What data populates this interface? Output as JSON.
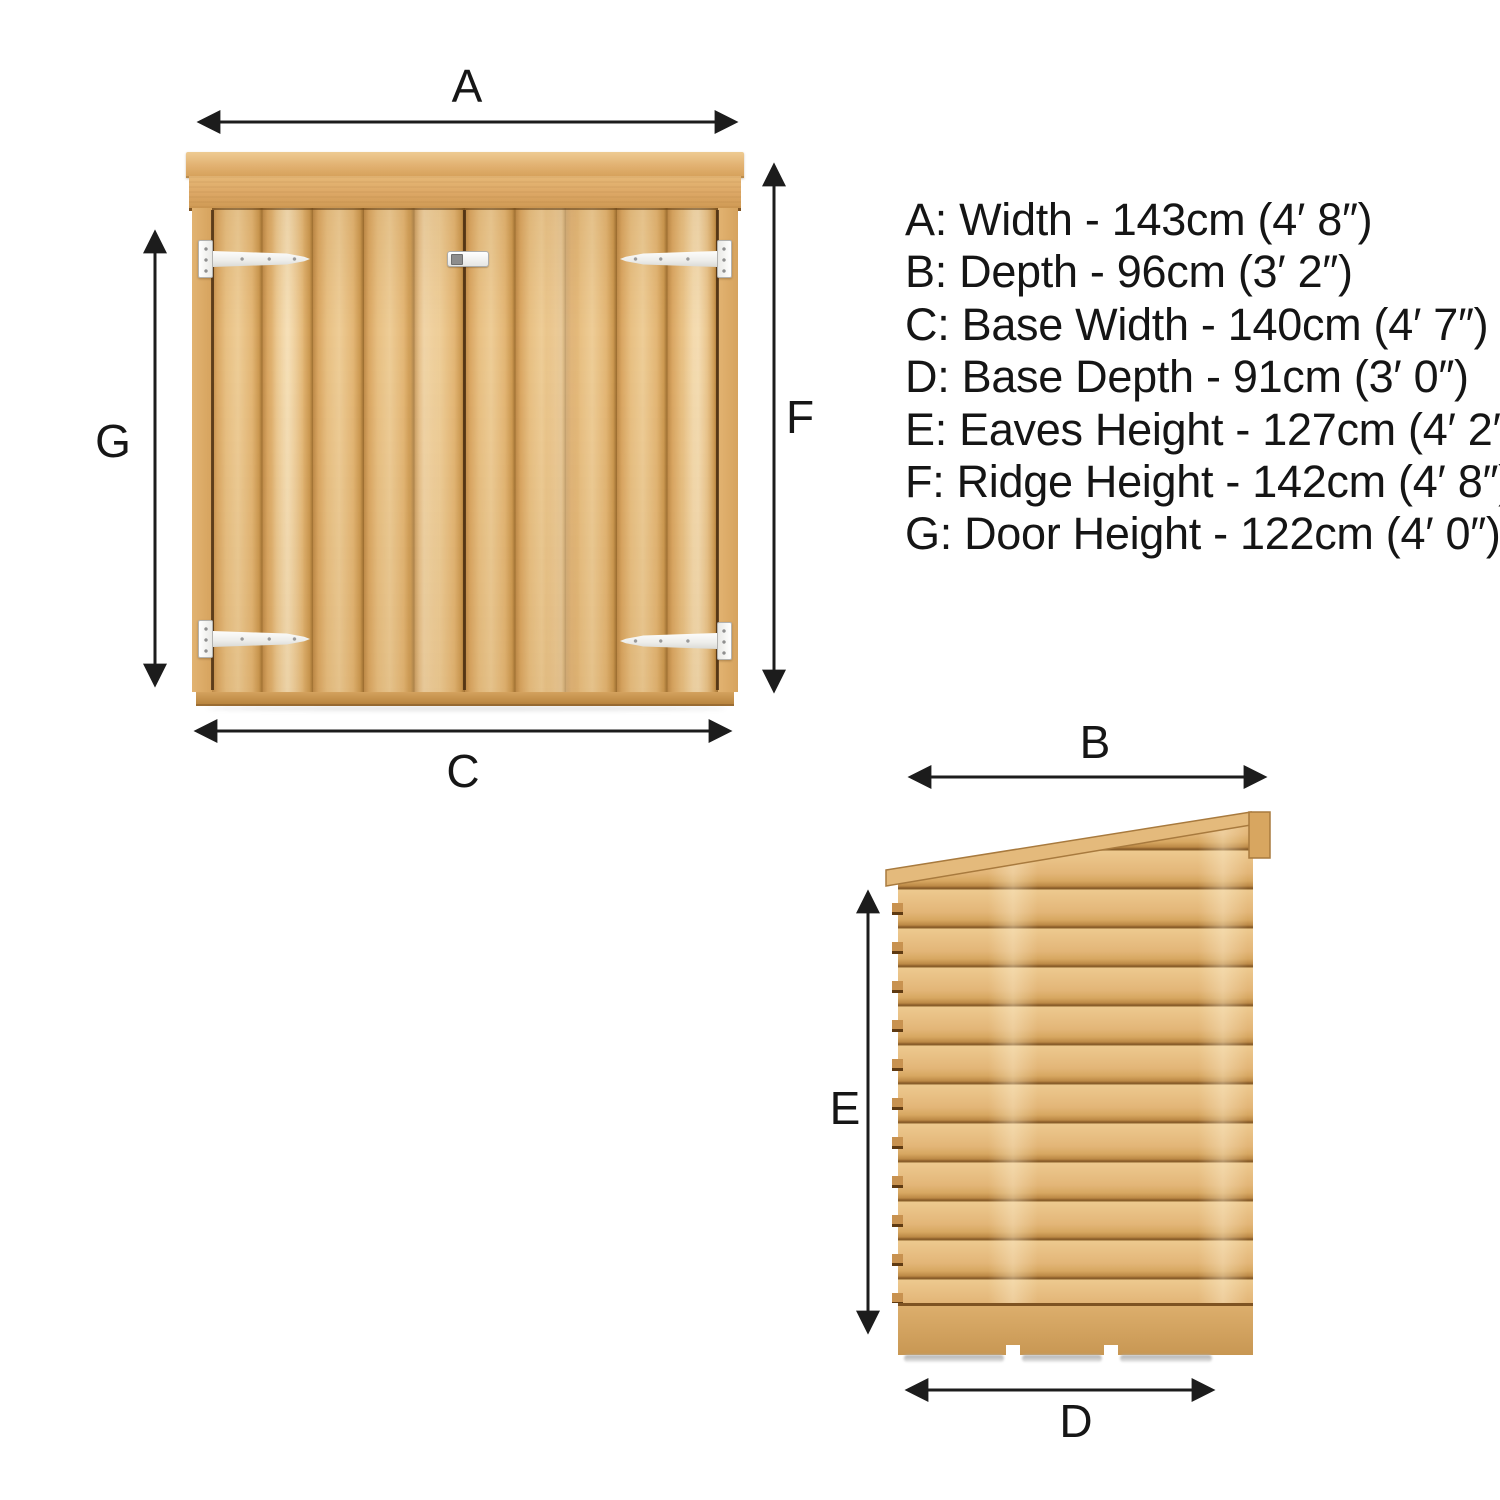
{
  "title": "Shed dimensions diagram",
  "colors": {
    "background": "#ffffff",
    "arrow": "#1c1c1c",
    "text": "#151515",
    "wood_light": "#eecd97",
    "wood_mid": "#ddae6c",
    "wood_dark": "#b07c3c",
    "wood_seam": "#7e5322",
    "hinge_white": "#f6f6f4",
    "hinge_border": "#b2b2b0",
    "shadow_gray": "#ababab"
  },
  "dimensions": [
    {
      "letter": "A",
      "name": "Width",
      "cm": "143cm",
      "imperial": "4′ 8″",
      "text": "A: Width - 143cm (4′ 8″)"
    },
    {
      "letter": "B",
      "name": "Depth",
      "cm": "96cm",
      "imperial": "3′ 2″",
      "text": "B: Depth - 96cm (3′ 2″)"
    },
    {
      "letter": "C",
      "name": "Base Width",
      "cm": "140cm",
      "imperial": "4′ 7″",
      "text": "C: Base Width - 140cm (4′ 7″)"
    },
    {
      "letter": "D",
      "name": "Base Depth",
      "cm": "91cm",
      "imperial": "3′ 0″",
      "text": "D: Base Depth - 91cm (3′ 0″)"
    },
    {
      "letter": "E",
      "name": "Eaves Height",
      "cm": "127cm",
      "imperial": "4′ 2″",
      "text": "E: Eaves Height - 127cm (4′ 2″)"
    },
    {
      "letter": "F",
      "name": "Ridge Height",
      "cm": "142cm",
      "imperial": "4′ 8″",
      "text": "F: Ridge Height - 142cm (4′ 8″)"
    },
    {
      "letter": "G",
      "name": "Door Height",
      "cm": "122cm",
      "imperial": "4′ 0″",
      "text": "G: Door Height - 122cm (4′ 0″)"
    }
  ],
  "views": {
    "front": {
      "name": "front elevation",
      "arrow_letters": [
        "A",
        "F",
        "G",
        "C"
      ]
    },
    "side": {
      "name": "side elevation",
      "arrow_letters": [
        "B",
        "E",
        "D"
      ]
    }
  }
}
